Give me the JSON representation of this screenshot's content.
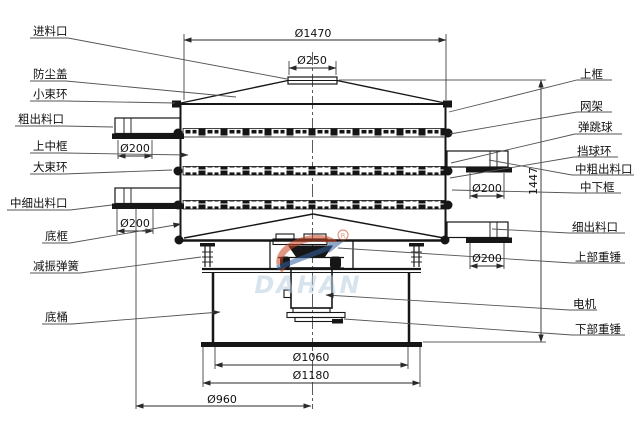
{
  "diagram_title": "rotary-vibrating-sieve-section-drawing",
  "labels": {
    "left": [
      {
        "id": "feed-inlet",
        "text": "进料口"
      },
      {
        "id": "dust-cover",
        "text": "防尘盖"
      },
      {
        "id": "small-clamp-ring",
        "text": "小束环"
      },
      {
        "id": "coarse-outlet",
        "text": "粗出料口"
      },
      {
        "id": "upper-middle-frame",
        "text": "上中框"
      },
      {
        "id": "large-clamp-ring",
        "text": "大束环"
      },
      {
        "id": "mid-fine-outlet",
        "text": "中细出料口"
      },
      {
        "id": "bottom-frame",
        "text": "底框"
      },
      {
        "id": "damping-spring",
        "text": "减振弹簧"
      },
      {
        "id": "base-barrel",
        "text": "底桶"
      }
    ],
    "right": [
      {
        "id": "upper-frame",
        "text": "上框"
      },
      {
        "id": "mesh-frame",
        "text": "网架"
      },
      {
        "id": "bouncing-ball",
        "text": "弹跳球"
      },
      {
        "id": "ball-stop-ring",
        "text": "挡球环"
      },
      {
        "id": "mid-coarse-outlet",
        "text": "中粗出料口"
      },
      {
        "id": "mid-lower-frame",
        "text": "中下框"
      },
      {
        "id": "fine-outlet",
        "text": "细出料口"
      },
      {
        "id": "upper-weight",
        "text": "上部重锤"
      },
      {
        "id": "motor",
        "text": "电机"
      },
      {
        "id": "lower-weight",
        "text": "下部重锤"
      }
    ]
  },
  "dimensions": {
    "top_outer_diameter": "Ø1470",
    "inlet_diameter": "Ø250",
    "left_upper_outlet": "Ø200",
    "left_lower_outlet": "Ø200",
    "right_upper_outlet": "Ø200",
    "right_lower_outlet": "Ø200",
    "overall_height": "1447",
    "base_barrel_diameter": "Ø1060",
    "base_plate_diameter": "Ø1180",
    "spring_circle_diameter": "Ø960"
  },
  "watermark": {
    "brand": "DAHAN",
    "registered_mark": "R",
    "accent_red": "#c84422",
    "accent_blue": "#35629f",
    "text_color": "#b9cfdf"
  }
}
